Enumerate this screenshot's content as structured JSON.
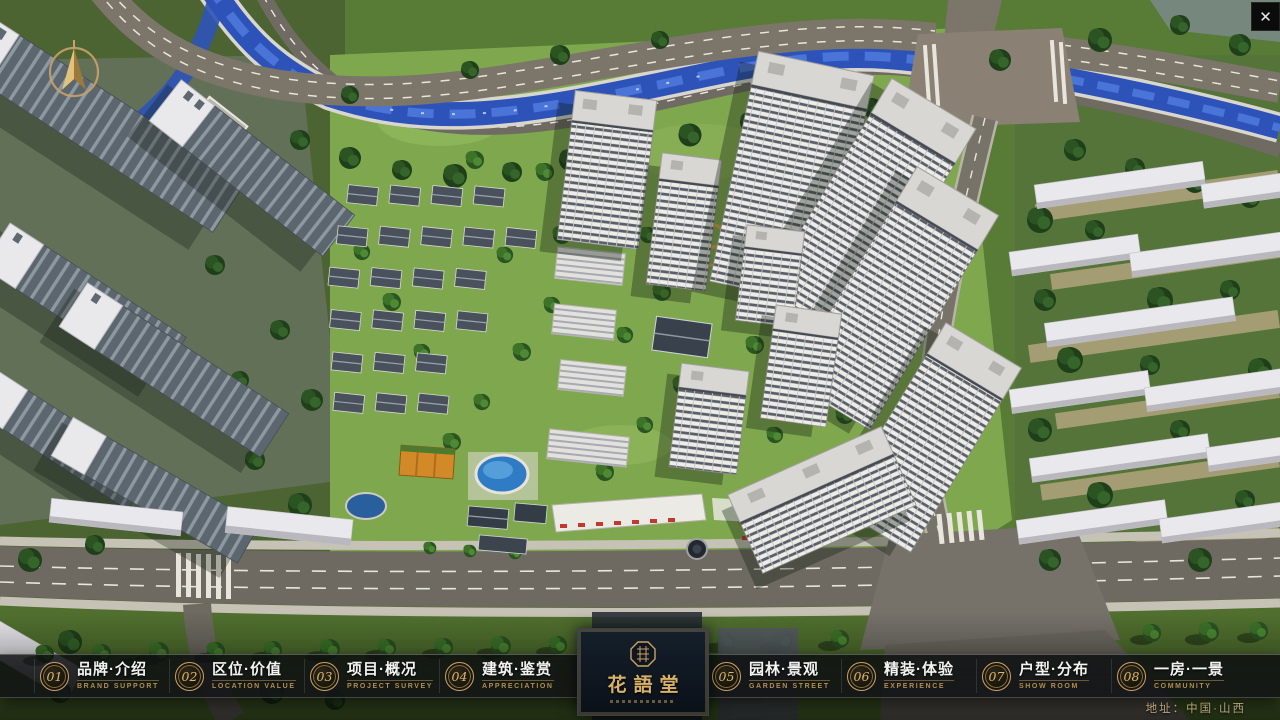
{
  "app": {
    "close_glyph": "✕"
  },
  "colors": {
    "gold_accent": "#c9a268",
    "bar_bg": "#0b0d0f",
    "river_blue": "#2d53b8"
  },
  "nav": {
    "items": [
      {
        "num": "01",
        "zh": "品牌·介绍",
        "en": "BRAND SUPPORT"
      },
      {
        "num": "02",
        "zh": "区位·价值",
        "en": "LOCATION VALUE"
      },
      {
        "num": "03",
        "zh": "项目·概况",
        "en": "PROJECT SURVEY"
      },
      {
        "num": "04",
        "zh": "建筑·鉴赏",
        "en": "APPRECIATION"
      },
      {
        "num": "05",
        "zh": "园林·景观",
        "en": "GARDEN STREET"
      },
      {
        "num": "06",
        "zh": "精装·体验",
        "en": "EXPERIENCE"
      },
      {
        "num": "07",
        "zh": "户型·分布",
        "en": "SHOW ROOM"
      },
      {
        "num": "08",
        "zh": "一房·一景",
        "en": "COMMUNITY"
      }
    ]
  },
  "logo": {
    "title": "花語堂"
  },
  "footer": {
    "address": "地址：中国·山西"
  }
}
